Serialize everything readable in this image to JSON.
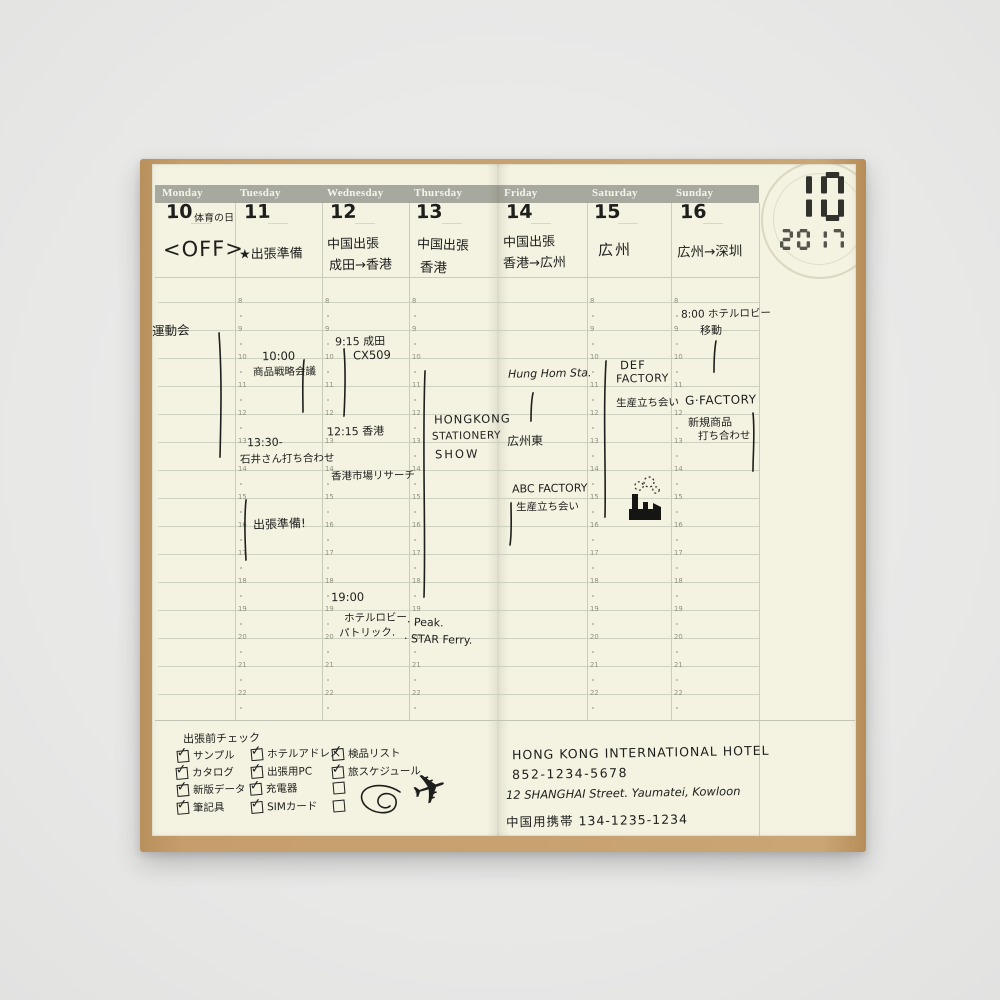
{
  "clock": {
    "month_display": "10",
    "year_display": "2017"
  },
  "planner": {
    "hours": [
      "8",
      "9",
      "10",
      "11",
      "12",
      "13",
      "14",
      "15",
      "16",
      "17",
      "18",
      "19",
      "20",
      "21",
      "22"
    ],
    "days": [
      {
        "name": "Monday",
        "date": "10",
        "date_note": "体育の日",
        "title_lines": [
          "<OFF>"
        ],
        "notes": [
          "運動会"
        ]
      },
      {
        "name": "Tuesday",
        "date": "11",
        "date_note": "",
        "title_lines": [
          "★出張準備"
        ],
        "notes": [
          "10:00",
          "商品戦略会議",
          "13:30-",
          "石井さん打ち合わせ",
          "出張準備!"
        ]
      },
      {
        "name": "Wednesday",
        "date": "12",
        "date_note": "",
        "title_lines": [
          "中国出張",
          "成田→香港"
        ],
        "notes": [
          "9:15 成田",
          "CX509",
          "12:15 香港",
          "香港市場リサーチ",
          "19:00",
          "ホテルロビー",
          "パトリック."
        ]
      },
      {
        "name": "Thursday",
        "date": "13",
        "date_note": "",
        "title_lines": [
          "中国出張",
          "香港"
        ],
        "notes": [
          "HONGKONG",
          "STATIONERY",
          "SHOW",
          "· Peak.",
          "· STAR Ferry."
        ]
      },
      {
        "name": "Friday",
        "date": "14",
        "date_note": "",
        "title_lines": [
          "中国出張",
          "香港→広州"
        ],
        "notes": [
          "Hung Hom Sta.",
          "広州東",
          "ABC FACTORY",
          "生産立ち会い"
        ]
      },
      {
        "name": "Saturday",
        "date": "15",
        "date_note": "",
        "title_lines": [
          "広州"
        ],
        "notes": [
          "DEF",
          "FACTORY",
          "生産立ち会い"
        ]
      },
      {
        "name": "Sunday",
        "date": "16",
        "date_note": "",
        "title_lines": [
          "広州→深圳"
        ],
        "notes": [
          "8:00 ホテルロビー",
          "移動",
          "G·FACTORY",
          "新規商品",
          "打ち合わせ"
        ]
      }
    ]
  },
  "checklist": {
    "title": "出張前チェック",
    "items": [
      {
        "checked": true,
        "label": "サンプル"
      },
      {
        "checked": true,
        "label": "カタログ"
      },
      {
        "checked": true,
        "label": "新版データ"
      },
      {
        "checked": true,
        "label": "筆記具"
      },
      {
        "checked": true,
        "label": "ホテルアドレス"
      },
      {
        "checked": true,
        "label": "出張用PC"
      },
      {
        "checked": true,
        "label": "充電器"
      },
      {
        "checked": true,
        "label": "SIMカード"
      },
      {
        "checked": true,
        "label": "検品リスト"
      },
      {
        "checked": true,
        "label": "旅スケジュール"
      },
      {
        "checked": false,
        "label": ""
      },
      {
        "checked": false,
        "label": ""
      }
    ]
  },
  "hotel": {
    "lines": [
      "HONG KONG INTERNATIONAL HOTEL",
      "852-1234-5678",
      "12 SHANGHAI Street. Yaumatei, Kowloon",
      "中国用携帯 134-1235-1234"
    ]
  },
  "colors": {
    "paper": "#f4f2e1",
    "header_band": "#a7a99e",
    "ink": "#1e1e1c",
    "grid": "#c9ccbb",
    "cover": "#c59e6c"
  }
}
